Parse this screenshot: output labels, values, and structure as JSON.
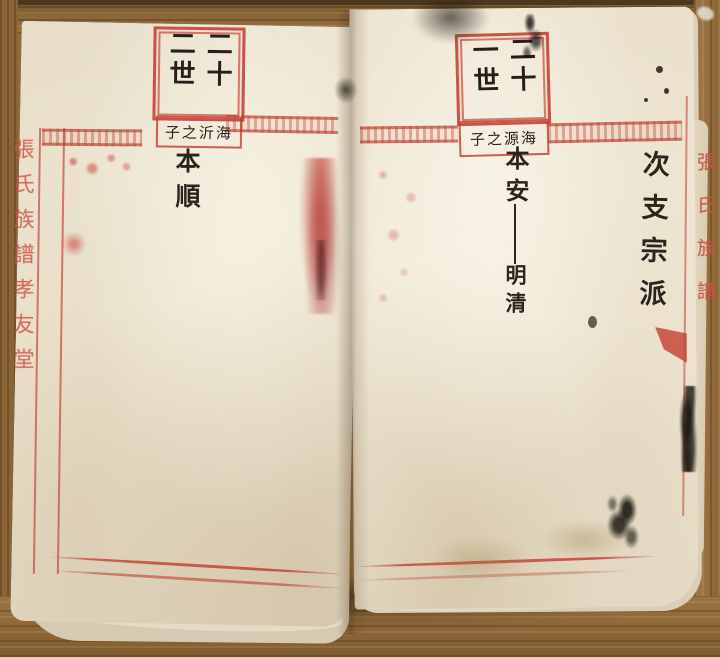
{
  "left_page": {
    "generation": "二十二世",
    "parent_note": "海沂之子",
    "name": "本順",
    "spine_title": "張氏族譜孝友堂"
  },
  "right_page": {
    "generation": "二十一世",
    "parent_note": "海源之子",
    "name": "本安",
    "child_name": "明清",
    "branch_label": "次支宗派",
    "spine_title": "張氏族譜"
  },
  "colors": {
    "print_red": "#c23a2e",
    "ink_black": "#2b241d",
    "paper": "#ece3cf",
    "wood": "#96703f"
  }
}
